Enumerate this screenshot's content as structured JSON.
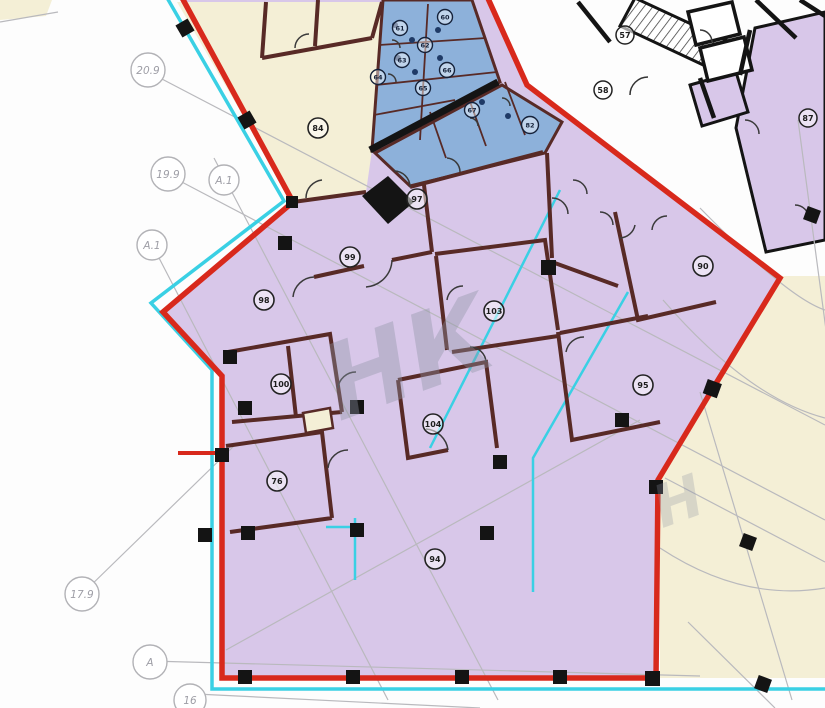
{
  "drawing": {
    "kind": "architectural-floor-plan",
    "watermark": {
      "text": "НК",
      "text2": "Н"
    }
  },
  "colors": {
    "paper": "#fdfdfd",
    "leased_area_fill": "#d8c7e9",
    "wet_rooms_fill": "#8db1da",
    "other_tenant_fill": "#f4efd6",
    "boundary_red": "#d8291c",
    "utility_cyan": "#3ad0e4",
    "wall_maroon": "#582a26",
    "wall_black": "#141414",
    "grid_gray": "#b9b9bd"
  },
  "axes": [
    {
      "label": "20.9"
    },
    {
      "label": "19.9"
    },
    {
      "label": "А.1"
    },
    {
      "label": "А.1"
    },
    {
      "label": "17.9"
    },
    {
      "label": "А"
    },
    {
      "label": "16"
    }
  ],
  "rooms": {
    "yellow": [
      {
        "number": "84"
      }
    ],
    "main": [
      {
        "number": "97"
      },
      {
        "number": "99"
      },
      {
        "number": "98"
      },
      {
        "number": "100"
      },
      {
        "number": "76"
      },
      {
        "number": "104"
      },
      {
        "number": "103"
      },
      {
        "number": "94"
      },
      {
        "number": "95"
      },
      {
        "number": "90"
      }
    ],
    "wc": [
      {
        "number": "60"
      },
      {
        "number": "61"
      },
      {
        "number": "62"
      },
      {
        "number": "63"
      },
      {
        "number": "64"
      },
      {
        "number": "65"
      },
      {
        "number": "66"
      },
      {
        "number": "67"
      },
      {
        "number": "82"
      }
    ],
    "corridor": [
      {
        "number": "57"
      },
      {
        "number": "58"
      }
    ],
    "outside": [
      {
        "number": "87"
      }
    ]
  }
}
